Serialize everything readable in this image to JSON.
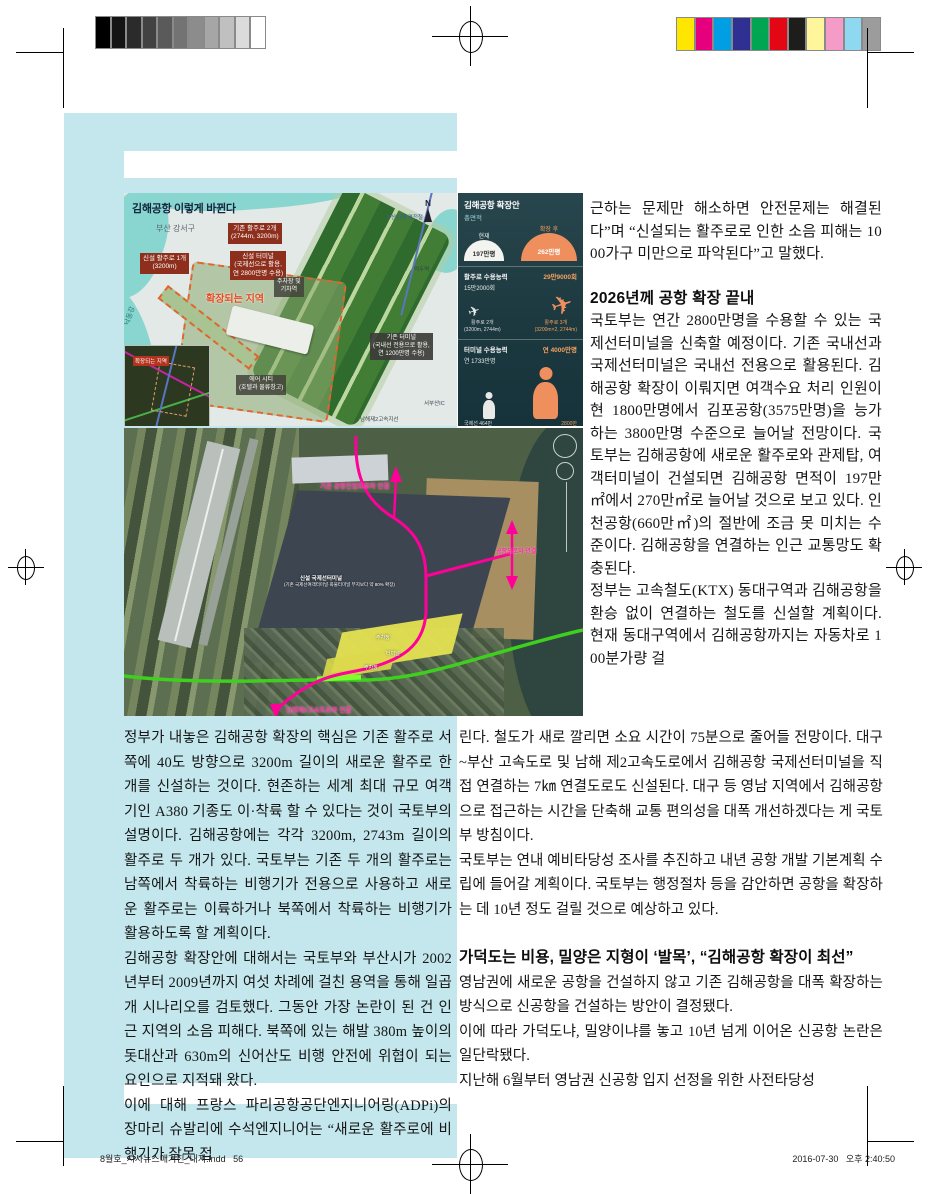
{
  "print_marks": {
    "grayscale_steps": [
      "#000000",
      "#141414",
      "#2b2b2b",
      "#424242",
      "#5a5a5a",
      "#737373",
      "#8c8c8c",
      "#a6a6a6",
      "#c0c0c0",
      "#dbdbdb",
      "#ffffff"
    ],
    "color_bar": [
      "#ffe600",
      "#e6007e",
      "#009fe3",
      "#2e3192",
      "#00a651",
      "#e30613",
      "#1d1d1b",
      "#fff59b",
      "#f59bc8",
      "#8fd8f2",
      "#9c9c9c"
    ],
    "slug_file": "8월호_시사뉴스매거진_내지.indd",
    "slug_page": "56",
    "slug_date": "2016-07-30",
    "slug_time": "오후 2:40:50"
  },
  "colors": {
    "panel_cyan": "#c3e7ed",
    "label_red": "#8d2f1c",
    "expansion_orange": "#e0662e",
    "infographic_orange": "#ef8f5e",
    "route_magenta": "#ff0099",
    "route_green": "#3fd01f"
  },
  "map": {
    "title": "김해공항 이렇게 바뀐다",
    "district": "부산 강서구",
    "river": "낙동강",
    "compass": "N",
    "existing_runways": "기존 활주로 2개",
    "existing_runways_sub": "(2744m, 3200m)",
    "new_runway": "신설 활주로 1개",
    "new_runway_sub": "(3200m)",
    "new_terminal": "신설 터미널",
    "new_terminal_sub1": "(국제선으로 활용,",
    "new_terminal_sub2": "연 2800만명 수용)",
    "expansion": "확장되는 지역",
    "parking1": "주차장 및",
    "parking2": "기차역",
    "aircity": "에어 시티",
    "aircity_sub": "(호텔과 물류창고)",
    "existing_terminal": "기존 터미널",
    "existing_terminal_sub1": "(국내선 전용으로 활용,",
    "existing_terminal_sub2": "연 1200만명 수용)",
    "lightrail": "부산김해 경전철",
    "station": "덕두역",
    "road": "남해제2고속지선",
    "ic": "서부산IC",
    "inset_label": "확장되는 지역"
  },
  "infographic": {
    "title": "김해공항 확장안",
    "area_section": "총면적",
    "area_current_label": "현재",
    "area_current": "197만평",
    "area_after_label": "확장 후",
    "area_after": "262만평",
    "runway_section": "활주로 수용능력",
    "runway_current": "15만2000회",
    "runway_after": "29만9000회",
    "runway_current_sub1": "활주로 2개",
    "runway_current_sub2": "(3200m, 2744m)",
    "runway_after_sub1": "활주로 3개",
    "runway_after_sub2": "(3200m×2, 2744m)",
    "terminal_section": "터미널 수용능력",
    "terminal_current": "연 1733만명",
    "terminal_after": "연 4000만명",
    "terminal_current_sub1": "국제선 464만",
    "terminal_current_sub2": "국내선 1269만",
    "terminal_after_sub1": "2800만",
    "terminal_after_sub2": "1200만",
    "plane_glyph": "✈"
  },
  "satellite": {
    "label_top": "기존 공항진입도로와 연결",
    "label_right": "공항도로와 연결",
    "label_bottom": "남해제2고속도로와 연결",
    "label_center": "신설 국제선터미널",
    "label_center_sub": "(기존 국제선여객터미널·화물터미널 부지보다 약 80% 확장)",
    "label_parking": "주차장",
    "label_terminal": "터미널"
  },
  "article": {
    "rt_p1": "근하는 문제만 해소하면 안전문제는 해결된다”며 “신설되는 활주로로 인한 소음 피해는 1000가구 미만으로 파악된다”고 말했다.",
    "rt_h1": "2026년께 공항 확장 끝내",
    "rt_p2": "국토부는 연간 2800만명을 수용할 수 있는 국제선터미널을 신축할 예정이다. 기존 국내선과 국제선터미널은 국내선 전용으로 활용된다. 김해공항 확장이 이뤄지면 여객수요 처리 인원이 현 1800만명에서 김포공항(3575만명)을 능가하는 3800만명 수준으로 늘어날 전망이다. 국토부는 김해공항에 새로운 활주로와 관제탑, 여객터미널이 건설되면 김해공항 면적이 197만㎡에서 270만㎡로 늘어날 것으로 보고 있다. 인천공항(660만㎡)의 절반에 조금 못 미치는 수준이다. 김해공항을 연결하는 인근 교통망도 확충된다.",
    "rt_p3": "정부는 고속철도(KTX) 동대구역과 김해공항을 환승 없이 연결하는 철도를 신설할 계획이다. 현재 동대구역에서 김해공항까지는 자동차로 100분가량 걸",
    "l_p1": "정부가 내놓은 김해공항 확장의 핵심은 기존 활주로 서쪽에 40도 방향으로 3200m 길이의 새로운 활주로 한 개를 신설하는 것이다. 현존하는 세계 최대 규모 여객기인 A380 기종도 이·착륙 할 수 있다는 것이 국토부의 설명이다. 김해공항에는 각각 3200m, 2743m 길이의 활주로 두 개가 있다. 국토부는 기존 두 개의 활주로는 남쪽에서 착륙하는 비행기가 전용으로 사용하고 새로운 활주로는 이륙하거나 북쪽에서 착륙하는 비행기가 활용하도록 할 계획이다.",
    "l_p2": "김해공항 확장안에 대해서는 국토부와 부산시가 2002년부터 2009년까지 여섯 차례에 걸친 용역을 통해 일곱 개 시나리오를 검토했다. 그동안 가장 논란이 된 건 인근 지역의 소음 피해다. 북쪽에 있는 해발 380m 높이의 돗대산과 630m의 신어산도 비행 안전에 위협이 되는 요인으로 지적돼 왔다.",
    "l_p3": "이에 대해 프랑스 파리공항공단엔지니어링(ADPi)의 장마리 슈발리에 수석엔지니어는 “새로운 활주로에 비행기가 잘못 접",
    "rb_p1": "린다. 철도가 새로 깔리면 소요 시간이 75분으로 줄어들 전망이다. 대구~부산 고속도로 및 남해 제2고속도로에서 김해공항 국제선터미널을 직접 연결하는 7㎞ 연결도로도 신설된다. 대구 등 영남 지역에서 김해공항으로 접근하는 시간을 단축해 교통 편의성을 대폭 개선하겠다는 게 국토부 방침이다.",
    "rb_p2": "국토부는 연내 예비타당성 조사를 추진하고 내년 공항 개발 기본계획 수립에 들어갈 계획이다. 국토부는 행정절차 등을 감안하면 공항을 확장하는 데 10년 정도 걸릴 것으로 예상하고 있다.",
    "rb_h1": "가덕도는 비용, 밀양은 지형이 ‘발목’, “김해공항 확장이 최선”",
    "rb_p3": "영남권에 새로운 공항을 건설하지 않고 기존 김해공항을 대폭 확장하는 방식으로 신공항을 건설하는 방안이 결정됐다.",
    "rb_p4": "이에 따라 가덕도냐, 밀양이냐를 놓고 10년 넘게 이어온 신공항 논란은 일단락됐다.",
    "rb_p5": "지난해 6월부터 영남권 신공항 입지 선정을 위한 사전타당성"
  }
}
